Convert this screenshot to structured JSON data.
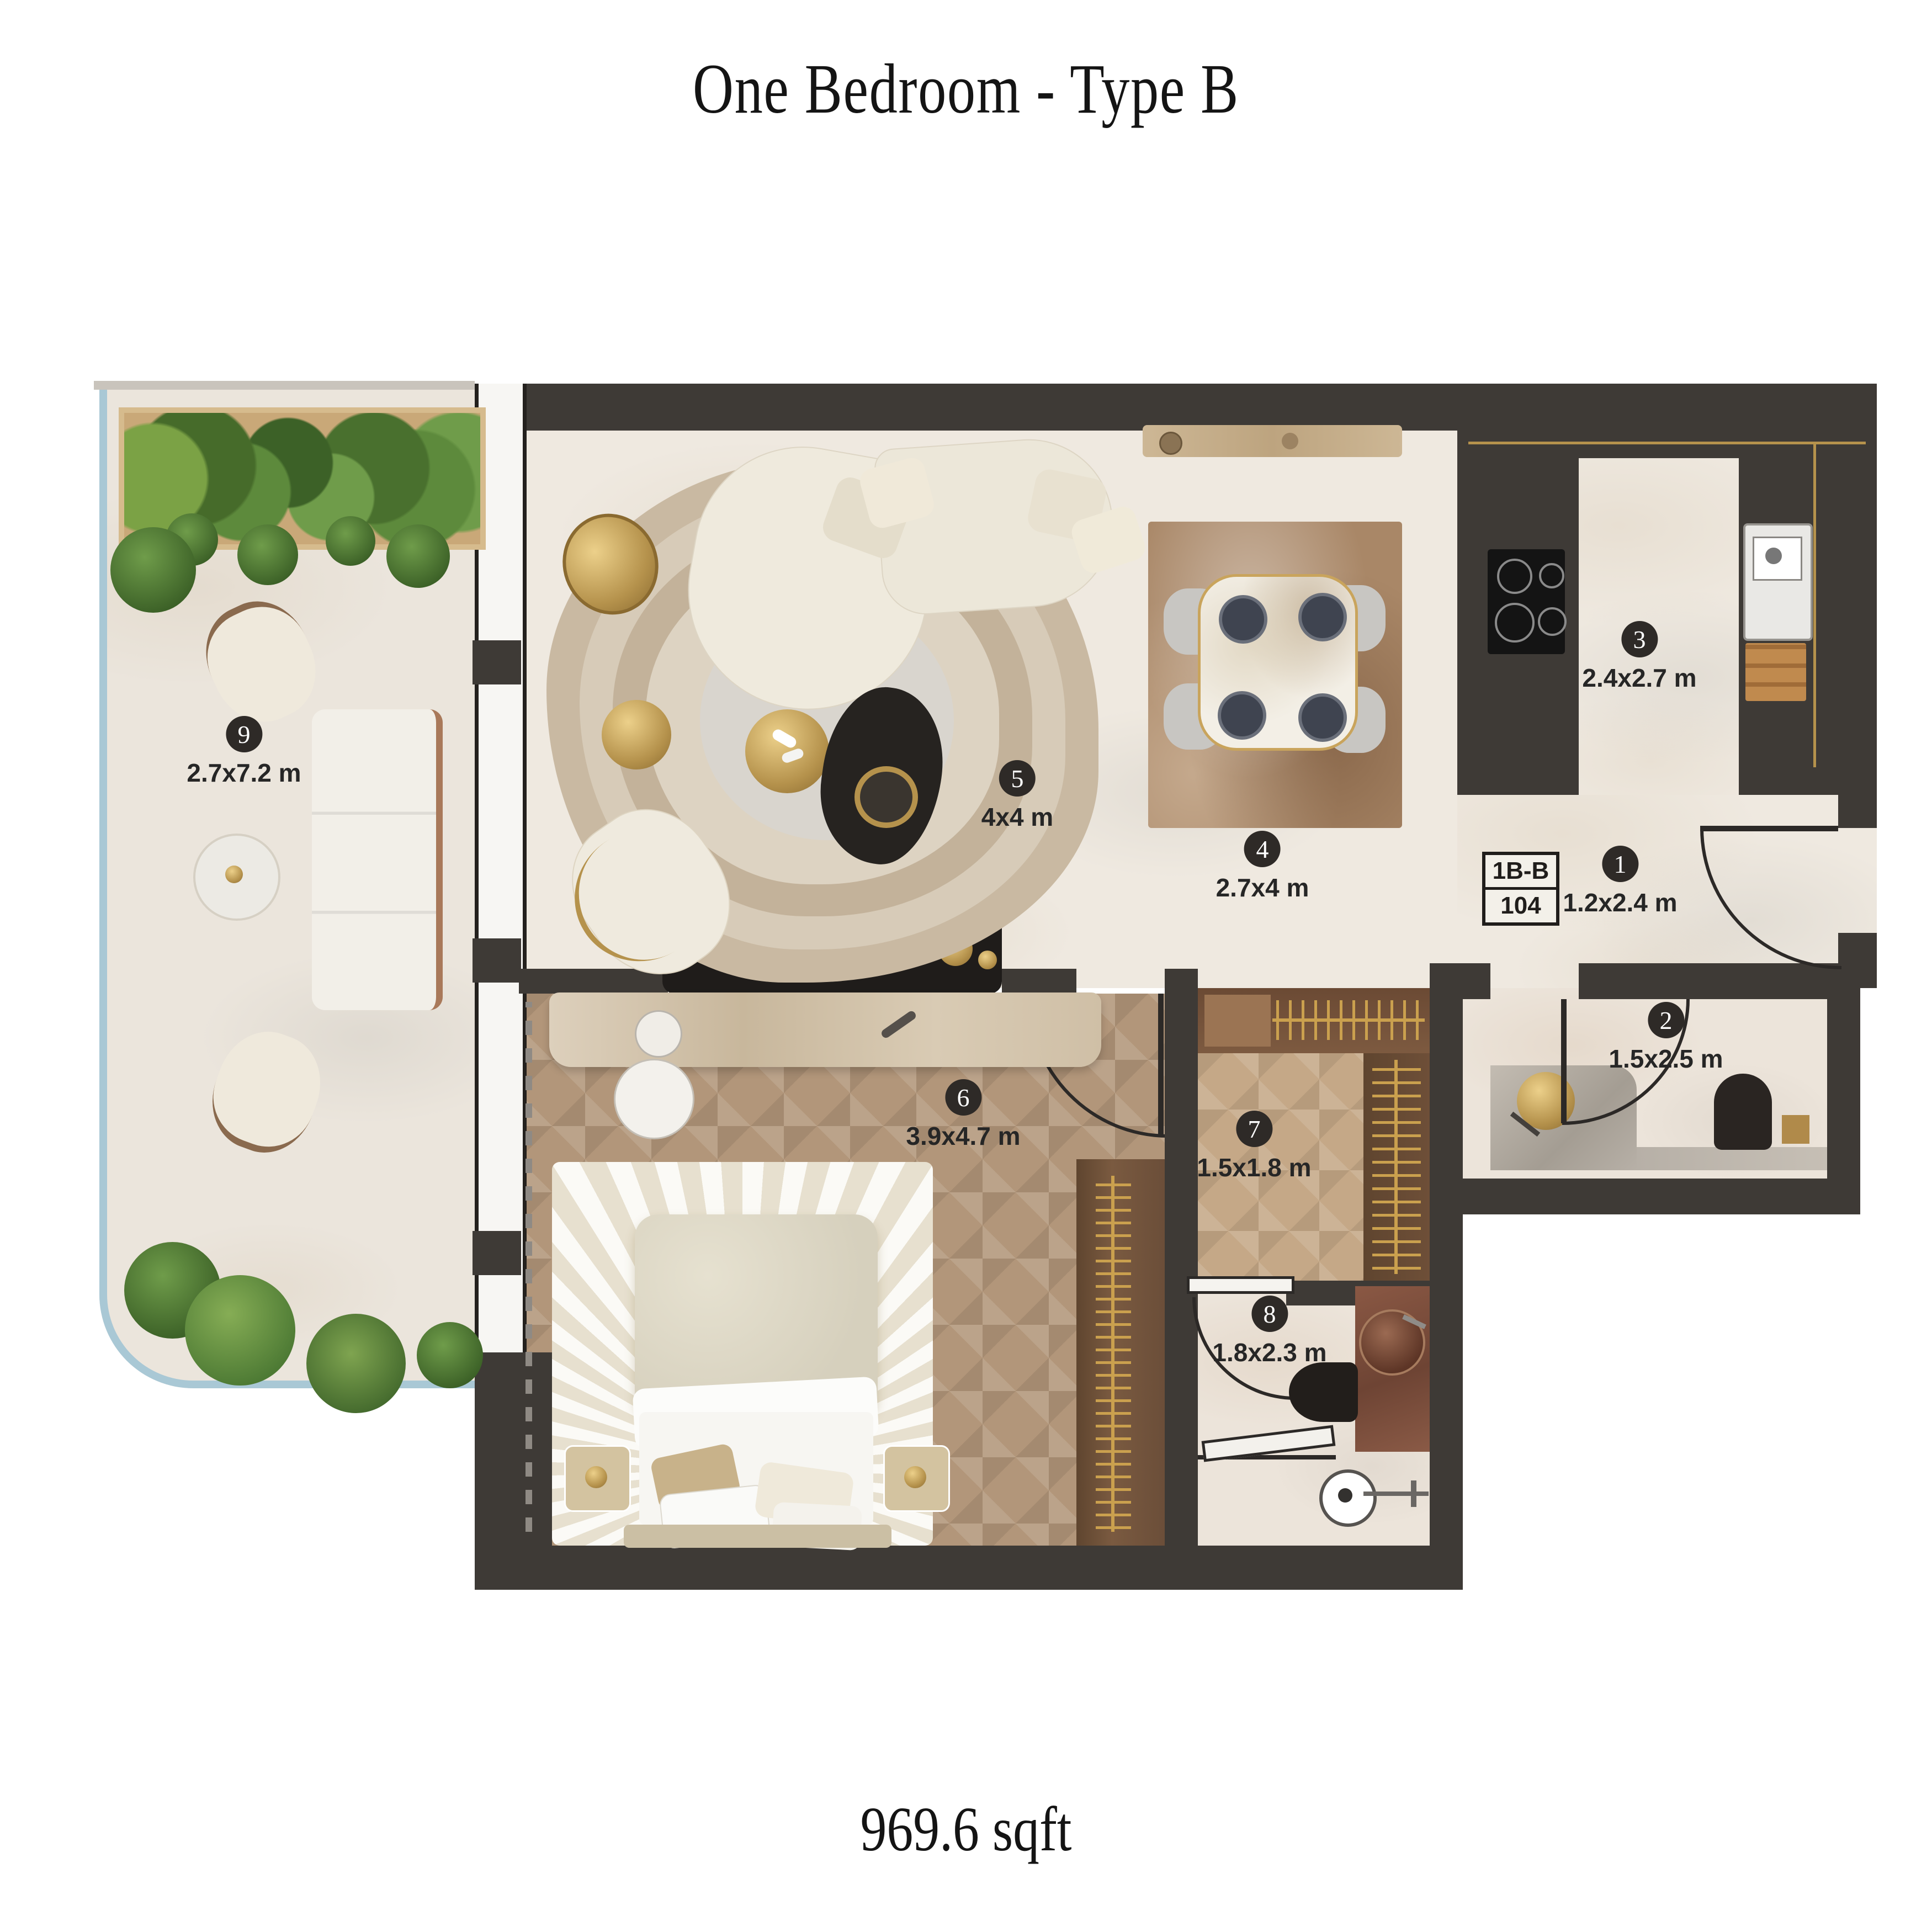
{
  "title": "One Bedroom - Type B",
  "area": "969.6 sqft",
  "unit_tag": {
    "type": "1B-B",
    "number": "104"
  },
  "rooms": [
    {
      "number": "1",
      "dims": "1.2x2.4 m"
    },
    {
      "number": "2",
      "dims": "1.5x2.5 m"
    },
    {
      "number": "3",
      "dims": "2.4x2.7 m"
    },
    {
      "number": "4",
      "dims": "2.7x4 m"
    },
    {
      "number": "5",
      "dims": "4x4 m"
    },
    {
      "number": "6",
      "dims": "3.9x4.7 m"
    },
    {
      "number": "7",
      "dims": "1.5x1.8 m"
    },
    {
      "number": "8",
      "dims": "1.8x2.3 m"
    },
    {
      "number": "9",
      "dims": "2.7x7.2 m"
    }
  ],
  "colors": {
    "wall": "#3e3a36",
    "accent_gold": "#b5924c",
    "balcony_glass": "#a9c8d5",
    "wood_floor": "#b2967a",
    "marble_floor": "#efe9e0",
    "badge": "#2e2a27"
  }
}
